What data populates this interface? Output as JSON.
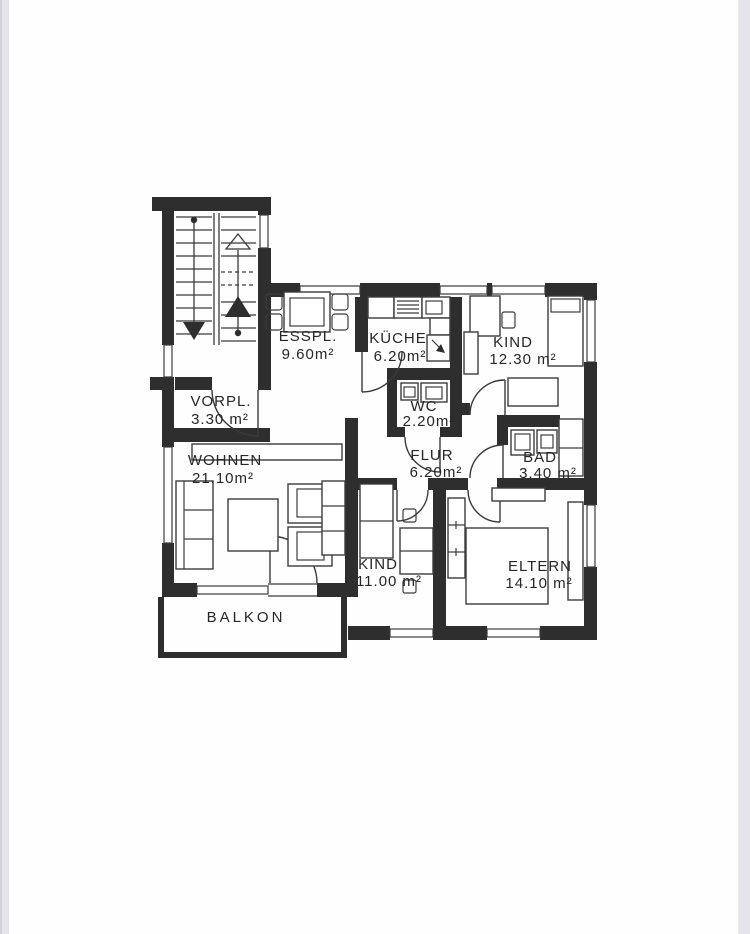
{
  "page": {
    "paper_color": "#fefefe",
    "edge_strip_color": "#e4e4ea",
    "ink_color": "#2e2e2e"
  },
  "rooms": {
    "esspl": {
      "name": "ESSPL.",
      "area": "9.60m²"
    },
    "kueche": {
      "name": "KÜCHE",
      "area": "6.20m²"
    },
    "kind1": {
      "name": "KIND",
      "area": "12.30 m²"
    },
    "vorpl": {
      "name": "VORPL.",
      "area": "3.30 m²"
    },
    "wc": {
      "name": "WC",
      "area": "2.20m²"
    },
    "wohnen": {
      "name": "WOHNEN",
      "area": "21.10m²"
    },
    "flur": {
      "name": "FLUR",
      "area": "6.20m²"
    },
    "bad": {
      "name": "BAD",
      "area": "3.40 m²"
    },
    "kind2": {
      "name": "KIND",
      "area": "11.00 m²"
    },
    "eltern": {
      "name": "ELTERN",
      "area": "14.10 m²"
    }
  },
  "balcony": {
    "label": "BALKON"
  }
}
